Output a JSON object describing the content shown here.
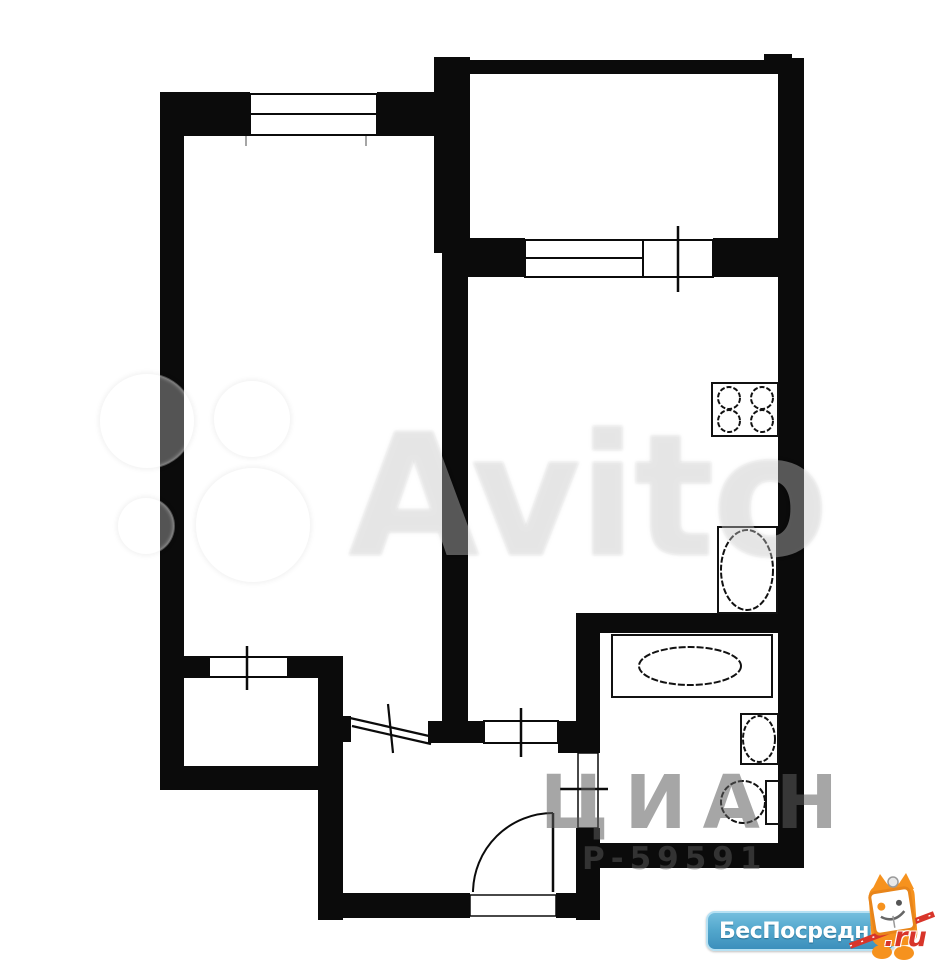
{
  "watermarks": {
    "avito": {
      "text": "Avito"
    },
    "cian": {
      "line1": "ЦИАН",
      "line2": "Р-59591"
    },
    "besposrednika": {
      "brand": "БесПосредника",
      "tld": ".ru"
    }
  },
  "colors": {
    "wall_black": "#0b0b0b",
    "logo_blue_top": "#74bede",
    "logo_blue_bottom": "#3c8fbc",
    "logo_border_blue": "#b7e1f3",
    "mascot_orange": "#f6921e",
    "pencil_red": "#d8352a",
    "faint_watermark_gray": "#999999"
  }
}
